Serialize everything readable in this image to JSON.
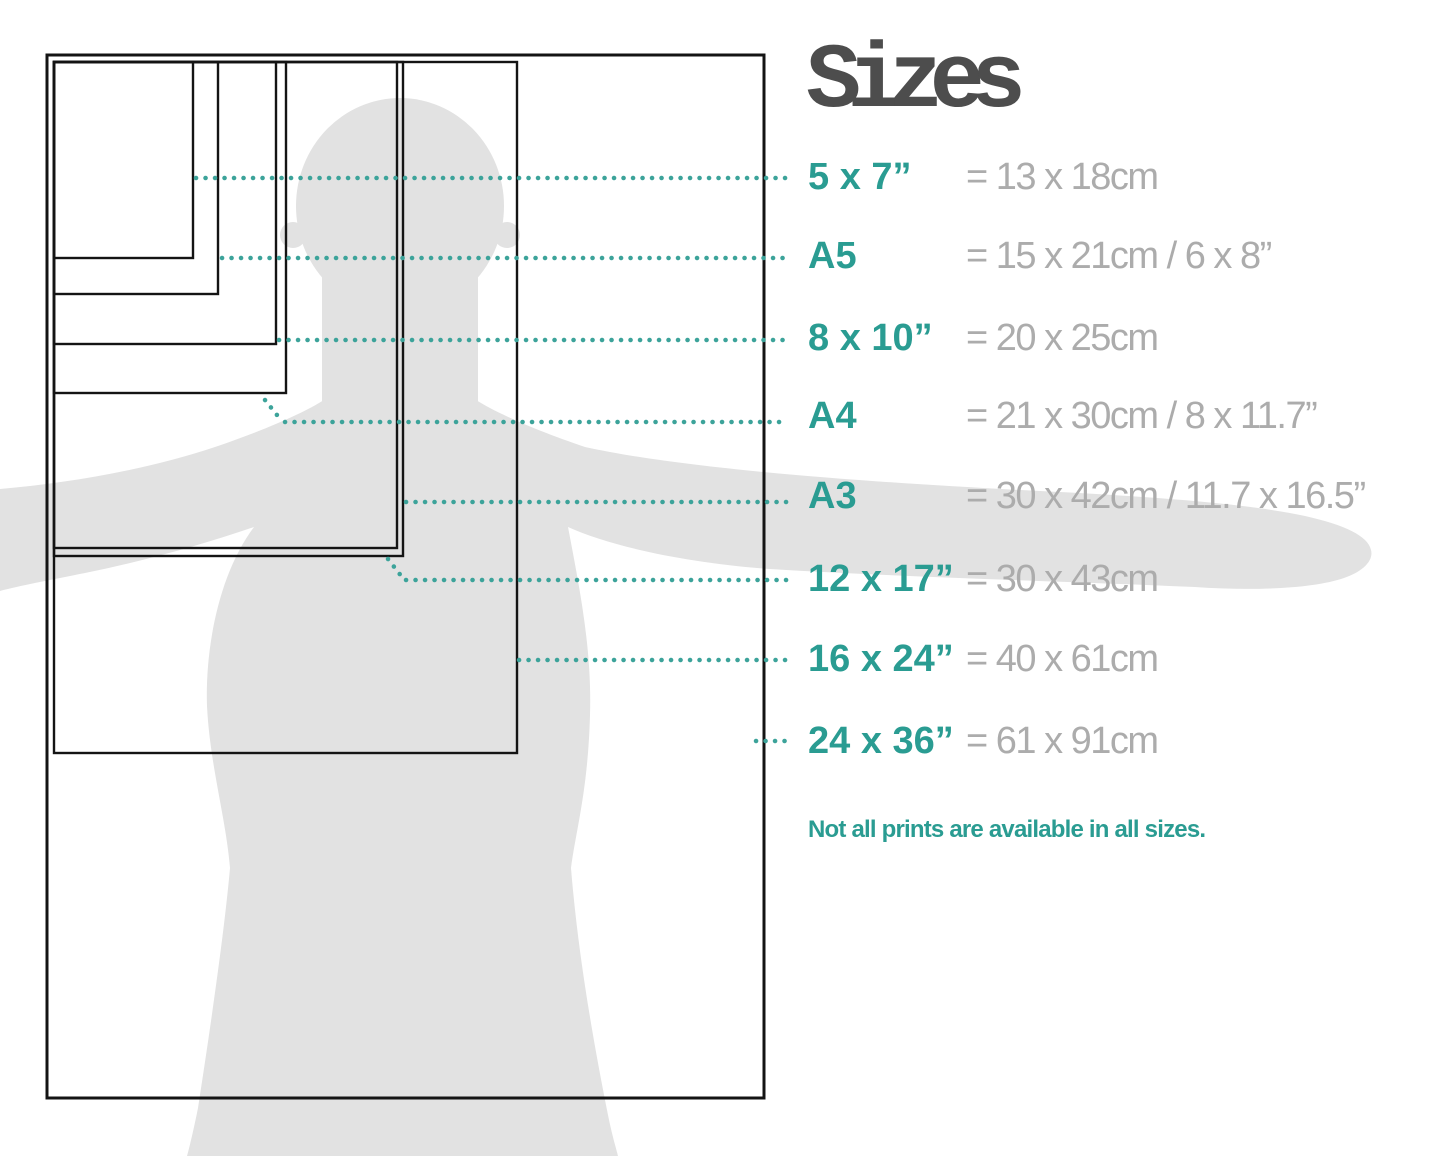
{
  "title": "Sizes",
  "note": "Not all prints are available in all sizes.",
  "colors": {
    "accent_teal": "#2a9c92",
    "leader_dots": "#3ca39a",
    "value_gray": "#acacac",
    "title_gray": "#4d4d4d",
    "silhouette_gray": "#e2e2e2",
    "rectangle_stroke": "#141414"
  },
  "sizes": [
    {
      "label": "5 x 7”",
      "value": "= 13 x 18cm"
    },
    {
      "label": "A5",
      "value": "= 15 x 21cm / 6 x 8”"
    },
    {
      "label": "8 x 10”",
      "value": "= 20 x 25cm"
    },
    {
      "label": "A4",
      "value": "= 21 x 30cm / 8 x 11.7”"
    },
    {
      "label": "A3",
      "value": "= 30 x 42cm / 11.7 x 16.5”"
    },
    {
      "label": "12 x 17”",
      "value": "= 30 x 43cm"
    },
    {
      "label": "16 x 24”",
      "value": "= 40 x 61cm"
    },
    {
      "label": "24 x 36”",
      "value": "= 61 x 91cm"
    }
  ]
}
